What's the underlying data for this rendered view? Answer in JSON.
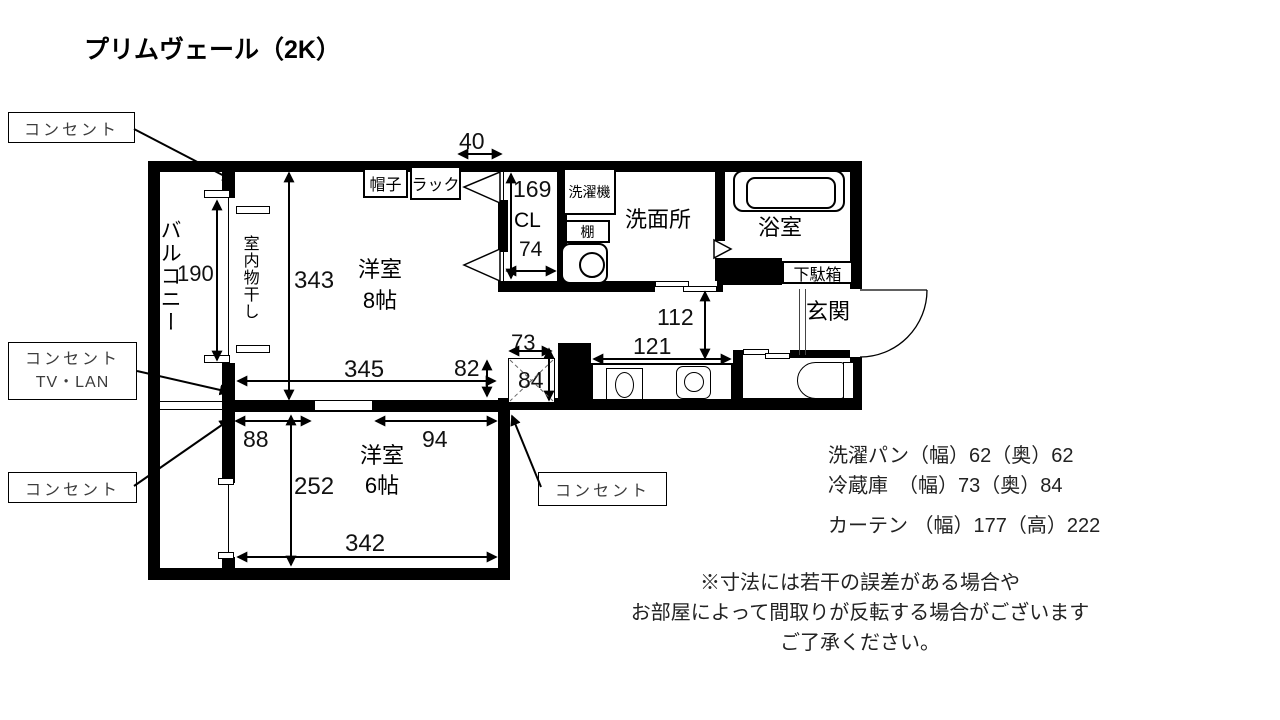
{
  "title": "プリムヴェール（2K）",
  "plan": {
    "rooms": {
      "balcony": "バルコニー",
      "indoor_drying": "室内物干し",
      "room8_name": "洋室",
      "room8_size": "8帖",
      "room6_name": "洋室",
      "room6_size": "6帖",
      "closet": "CL",
      "washroom": "洗面所",
      "bathroom": "浴室",
      "entrance": "玄関"
    },
    "fixtures": {
      "hat": "帽子",
      "rack": "ラック",
      "washing_machine": "洗濯機",
      "shelf": "棚",
      "shoe_cabinet": "下駄箱"
    },
    "dims": {
      "top_opening": "40",
      "closet_height": "169",
      "closet_width": "74",
      "balcony_window": "190",
      "room8_depth": "343",
      "room8_width": "345",
      "room8_corner": "82",
      "fridge_width": "73",
      "fridge_depth": "84",
      "hall_depth": "112",
      "counter_width": "121",
      "room6_wall_left": "88",
      "room6_wall_right": "94",
      "room6_depth": "252",
      "room6_width": "342"
    },
    "callouts": {
      "outlet": "コンセント",
      "outlet_tv_lan_line1": "コンセント",
      "outlet_tv_lan_line2": "TV・LAN"
    }
  },
  "specs": [
    "洗濯パン（幅）62（奥）62",
    "冷蔵庫　（幅）73（奥）84",
    "カーテン （幅）177（高）222"
  ],
  "note": [
    "※寸法には若干の誤差がある場合や",
    "お部屋によって間取りが反転する場合がございます",
    "ご了承ください。"
  ],
  "colors": {
    "wall": "#000000",
    "background": "#ffffff"
  }
}
